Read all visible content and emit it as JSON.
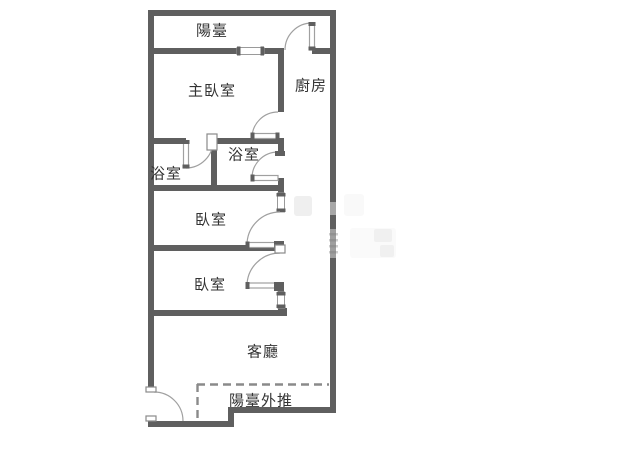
{
  "floorplan": {
    "title": "apartment floor plan",
    "rooms": [
      {
        "id": "balcony-top",
        "label": "陽臺"
      },
      {
        "id": "master-bedroom",
        "label": "主臥室"
      },
      {
        "id": "kitchen",
        "label": "廚房"
      },
      {
        "id": "bathroom-left",
        "label": "浴室"
      },
      {
        "id": "bathroom-right",
        "label": "浴室"
      },
      {
        "id": "bedroom-1",
        "label": "臥室"
      },
      {
        "id": "bedroom-2",
        "label": "臥室"
      },
      {
        "id": "living-room",
        "label": "客廳"
      },
      {
        "id": "balcony-extension",
        "label": "陽臺外推"
      }
    ],
    "colors": {
      "wall": "#5f5f5f",
      "thin_line": "#a0a0a0",
      "dashed_line": "#8a8a8a",
      "text": "#333333",
      "background": "#ffffff"
    }
  }
}
